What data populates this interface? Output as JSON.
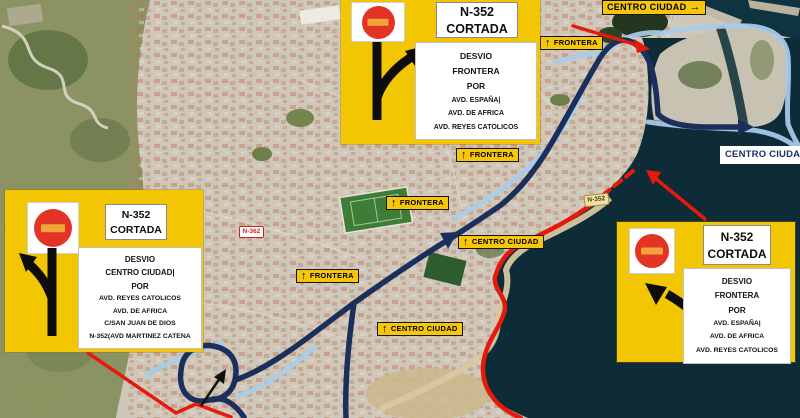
{
  "signs": {
    "top": {
      "road": "N-352",
      "status": "CORTADA",
      "detour": [
        "DESVIO",
        "FRONTERA",
        "POR",
        "AVD. ESPAÑA|",
        "AVD. DE AFRICA",
        "AVD. REYES CATOLICOS"
      ]
    },
    "left": {
      "road": "N-352",
      "status": "CORTADA",
      "detour": [
        "DESVIO",
        "CENTRO CIUDAD|",
        "POR",
        "AVD. REYES CATOLICOS",
        "AVD. DE AFRICA",
        "C/SAN JUAN DE DIOS",
        "N-352(AVD MARTINEZ CATENA"
      ]
    },
    "right": {
      "road": "N-352",
      "status": "CORTADA",
      "detour": [
        "DESVIO",
        "FRONTERA",
        "POR",
        "AVD. ESPAÑA|",
        "AVD. DE AFRICA",
        "AVD. REYES CATOLICOS"
      ]
    }
  },
  "labels": {
    "frontera": [
      {
        "text": "FRONTERA"
      },
      {
        "text": "FRONTERA"
      },
      {
        "text": "FRONTERA"
      },
      {
        "text": "FRONTERA"
      }
    ],
    "centro_up": [
      {
        "text": "CENTRO CIUDAD"
      },
      {
        "text": "CENTRO CIUDAD"
      }
    ],
    "centro_top": {
      "text": "CENTRO CIUDAD"
    },
    "centro_right": {
      "text": "CENTRO CIUDAD"
    },
    "badges": [
      {
        "text": "N-362"
      },
      {
        "text": "N-352"
      }
    ],
    "up_arrow": "↑",
    "right_arrow": "→"
  },
  "colors": {
    "sign_yellow": "#F3C603",
    "label_yellow": "#F6C60A",
    "route_blue": "#1B2F5C",
    "street_blue": "#A9CDEB",
    "closed_red": "#E61A0C",
    "sea": "#0E2C38",
    "no_entry_red": "#E33325",
    "no_entry_bar": "#F2A43B"
  }
}
